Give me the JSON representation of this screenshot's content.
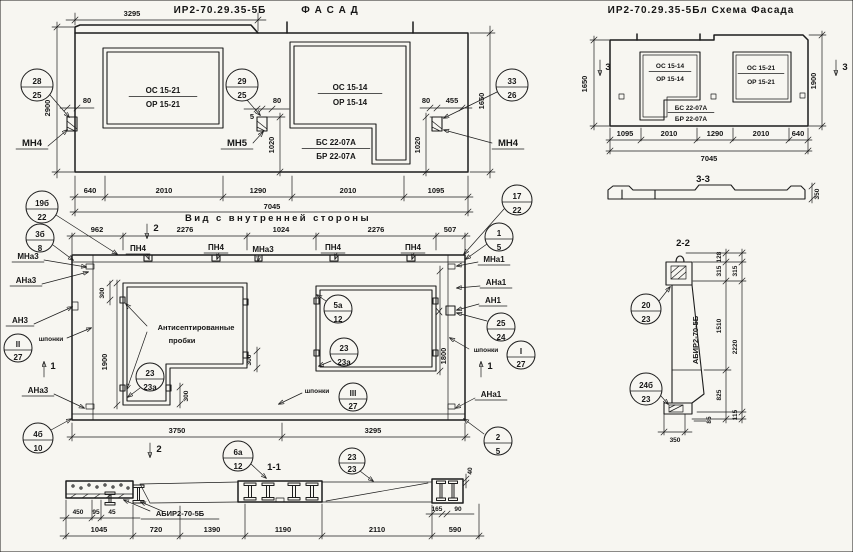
{
  "facade": {
    "title": "ИР2-70.29.35-5Б",
    "title2": "Ф А С А Д",
    "win_left": {
      "top": "ОС 15-21",
      "bot": "ОР 15-21"
    },
    "win_right": {
      "top": "ОС 15-14",
      "bot": "ОР 15-14"
    },
    "balcony": {
      "top": "БС 22-07А",
      "bot": "БР 22-07А"
    },
    "mount_left": "МН4",
    "mount_mid": "МН5",
    "mount_right": "МН4",
    "c28": {
      "n": "28",
      "d": "25"
    },
    "c29": {
      "n": "29",
      "d": "25"
    },
    "c33": {
      "n": "33",
      "d": "26"
    },
    "dims": {
      "w3295": "3295",
      "h2900": "2900",
      "g80l": "80",
      "g5": "5",
      "g80m": "80",
      "g80r": "80",
      "g455": "455",
      "v1020m": "1020",
      "v1020r": "1020",
      "v1650": "1650",
      "b640": "640",
      "b2010a": "2010",
      "b1290": "1290",
      "b2010b": "2010",
      "b1095": "1095",
      "total": "7045"
    }
  },
  "scheme": {
    "title": "ИР2-70.29.35-5Бл Схема Фасада",
    "win_left": {
      "top": "ОС 15-14",
      "bot": "ОР 15-14"
    },
    "balcony": {
      "top": "БС 22-07А",
      "bot": "БР 22-07А"
    },
    "win_right": {
      "top": "ОС 15-21",
      "bot": "ОР 15-21"
    },
    "mark3l": "3",
    "mark3r": "3",
    "dims": {
      "v1650": "1650",
      "v1900": "1900",
      "b1095": "1095",
      "b2010a": "2010",
      "b1290": "1290",
      "b2010b": "2010",
      "b640": "640",
      "total": "7045"
    }
  },
  "s33": {
    "title": "3-3",
    "d350": "350"
  },
  "s22": {
    "title": "2-2",
    "label": "АБИР2-70-5Б",
    "c20": {
      "n": "20",
      "d": "23"
    },
    "c24": {
      "n": "24б",
      "d": "23"
    },
    "dims": {
      "d128": "128",
      "d315a": "315",
      "d315b": "315",
      "d1510": "1510",
      "d2220": "2220",
      "d825": "825",
      "d115": "115",
      "d85": "85",
      "d350": "350"
    }
  },
  "interior": {
    "title": "Вид с внутренней стороны",
    "plugs1": "Антисептированные",
    "plugs2": "пробки",
    "shponki_l": "шпонки",
    "shponki_m": "шпонки",
    "shponki_r": "шпонки",
    "labels": {
      "pn4a": "ПН4",
      "pn4b": "ПН4",
      "pn4c": "ПН4",
      "pn4d": "ПН4",
      "mna3t": "МНа3",
      "mna1t": "МНа1",
      "mna3": "МНа3",
      "ana3": "АНа3",
      "an3": "АН3",
      "ana3b": "АНа3",
      "ana1": "АНа1",
      "an1": "АН1",
      "ana1b": "АНа1"
    },
    "marks": {
      "m2t": "2",
      "m2b": "2",
      "m1l": "1",
      "m1r": "1"
    },
    "circles": {
      "c19": {
        "n": "19б",
        "d": "22"
      },
      "c3": {
        "n": "3б",
        "d": "8"
      },
      "c17": {
        "n": "17",
        "d": "22"
      },
      "c1": {
        "n": "1",
        "d": "5"
      },
      "cII": {
        "n": "II",
        "d": "27"
      },
      "cI": {
        "n": "I",
        "d": "27"
      },
      "cIII": {
        "n": "III",
        "d": "27"
      },
      "c25": {
        "n": "25",
        "d": "24"
      },
      "c23l": {
        "n": "23",
        "d": "23а"
      },
      "c5": {
        "n": "5а",
        "d": "12"
      },
      "c23r": {
        "n": "23",
        "d": "23а"
      },
      "c4": {
        "n": "4б",
        "d": "10"
      },
      "c2": {
        "n": "2",
        "d": "5"
      },
      "c6": {
        "n": "6а",
        "d": "12"
      }
    },
    "dims": {
      "t962": "962",
      "t2276a": "2276",
      "t1024": "1024",
      "t2276b": "2276",
      "t507": "507",
      "v300a": "300",
      "v300b": "300",
      "v300c": "300",
      "v1900": "1900",
      "v1800": "1800",
      "b3750": "3750",
      "b3295": "3295"
    }
  },
  "s11": {
    "title": "1-1",
    "label": "АБИР2-70-5Б",
    "c23": {
      "n": "23",
      "d": "23"
    },
    "dims": {
      "d450": "450",
      "d95": "95",
      "d45": "45",
      "d1045": "1045",
      "d720": "720",
      "d1390": "1390",
      "d1190": "1190",
      "d2110": "2110",
      "d165": "165",
      "d90": "90",
      "d590": "590",
      "d40": "40"
    }
  }
}
